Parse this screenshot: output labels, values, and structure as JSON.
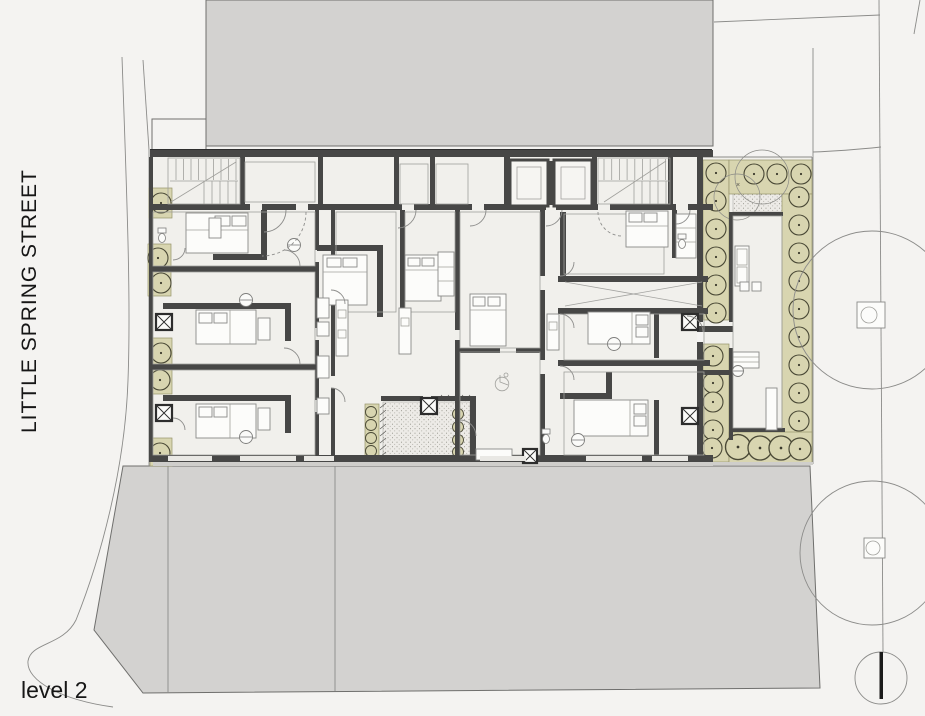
{
  "labels": {
    "street": "LITTLE SPRING STREET",
    "level": "level 2",
    "courtyard_marker": "×"
  },
  "palette": {
    "bg": "#f4f3f1",
    "building": "#d3d2d0",
    "building-stroke": "#6f6f6d",
    "wall": "#474746",
    "floor": "#f1f0ec",
    "planter": "#d8d5b0",
    "line": "#8b8b89",
    "sill": "#cfcecb",
    "text": "#161616"
  }
}
